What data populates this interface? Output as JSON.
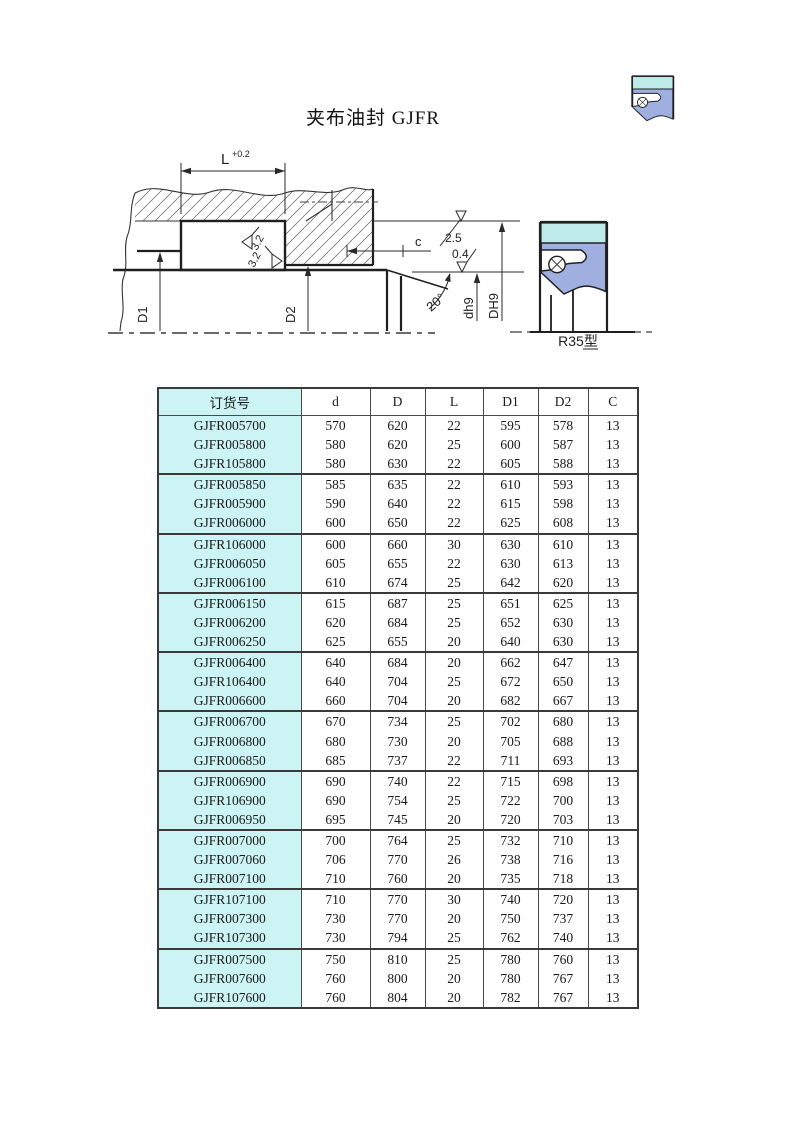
{
  "page_title": "夹布油封 GJFR",
  "drawing": {
    "dim_labels": {
      "L": "L",
      "L_tolerance": "+0.2",
      "c": "c",
      "D1": "D1",
      "D2": "D2",
      "shaft": "dh9",
      "housing_bore": "DH9",
      "chamfer_angle": "20°"
    },
    "surface_finish": {
      "groove_left": "3.2",
      "groove_bottom": "3.2",
      "face": "2.5",
      "shaft": "0.4"
    },
    "seal_type": "R35型"
  },
  "colors": {
    "seal_body": "#9fafdf",
    "seal_fabric": "#bfeaea",
    "table_highlight": "#cdf4f5"
  },
  "table": {
    "group_size": 3,
    "headers": [
      "订货号",
      "d",
      "D",
      "L",
      "D1",
      "D2",
      "C"
    ],
    "rows": [
      [
        "GJFR005700",
        570,
        620,
        22,
        595,
        578,
        13
      ],
      [
        "GJFR005800",
        580,
        620,
        25,
        600,
        587,
        13
      ],
      [
        "GJFR105800",
        580,
        630,
        22,
        605,
        588,
        13
      ],
      [
        "GJFR005850",
        585,
        635,
        22,
        610,
        593,
        13
      ],
      [
        "GJFR005900",
        590,
        640,
        22,
        615,
        598,
        13
      ],
      [
        "GJFR006000",
        600,
        650,
        22,
        625,
        608,
        13
      ],
      [
        "GJFR106000",
        600,
        660,
        30,
        630,
        610,
        13
      ],
      [
        "GJFR006050",
        605,
        655,
        22,
        630,
        613,
        13
      ],
      [
        "GJFR006100",
        610,
        674,
        25,
        642,
        620,
        13
      ],
      [
        "GJFR006150",
        615,
        687,
        25,
        651,
        625,
        13
      ],
      [
        "GJFR006200",
        620,
        684,
        25,
        652,
        630,
        13
      ],
      [
        "GJFR006250",
        625,
        655,
        20,
        640,
        630,
        13
      ],
      [
        "GJFR006400",
        640,
        684,
        20,
        662,
        647,
        13
      ],
      [
        "GJFR106400",
        640,
        704,
        25,
        672,
        650,
        13
      ],
      [
        "GJFR006600",
        660,
        704,
        20,
        682,
        667,
        13
      ],
      [
        "GJFR006700",
        670,
        734,
        25,
        702,
        680,
        13
      ],
      [
        "GJFR006800",
        680,
        730,
        20,
        705,
        688,
        13
      ],
      [
        "GJFR006850",
        685,
        737,
        22,
        711,
        693,
        13
      ],
      [
        "GJFR006900",
        690,
        740,
        22,
        715,
        698,
        13
      ],
      [
        "GJFR106900",
        690,
        754,
        25,
        722,
        700,
        13
      ],
      [
        "GJFR006950",
        695,
        745,
        20,
        720,
        703,
        13
      ],
      [
        "GJFR007000",
        700,
        764,
        25,
        732,
        710,
        13
      ],
      [
        "GJFR007060",
        706,
        770,
        26,
        738,
        716,
        13
      ],
      [
        "GJFR007100",
        710,
        760,
        20,
        735,
        718,
        13
      ],
      [
        "GJFR107100",
        710,
        770,
        30,
        740,
        720,
        13
      ],
      [
        "GJFR007300",
        730,
        770,
        20,
        750,
        737,
        13
      ],
      [
        "GJFR107300",
        730,
        794,
        25,
        762,
        740,
        13
      ],
      [
        "GJFR007500",
        750,
        810,
        25,
        780,
        760,
        13
      ],
      [
        "GJFR007600",
        760,
        800,
        20,
        780,
        767,
        13
      ],
      [
        "GJFR107600",
        760,
        804,
        20,
        782,
        767,
        13
      ]
    ]
  }
}
